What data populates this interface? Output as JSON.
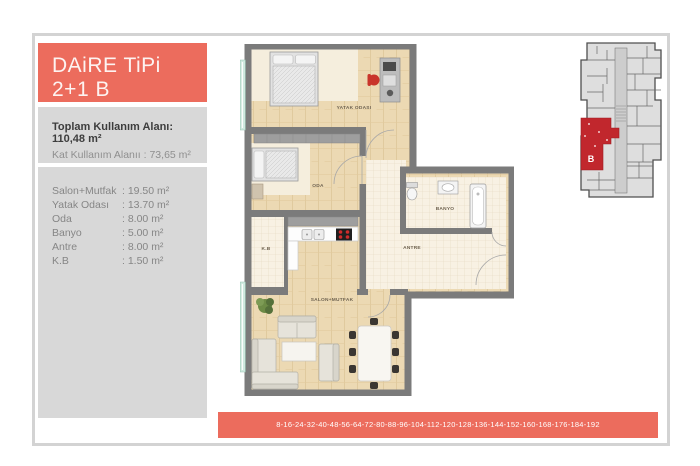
{
  "colors": {
    "coral": "#ec6c5d",
    "unit_red": "#c1272d",
    "wall_gray": "#7b7b7b"
  },
  "header": {
    "title_line1": "DAiRE TiPi",
    "title_line2": "2+1 B"
  },
  "stats": {
    "line1": "Toplam Kullanım Alanı: 110,48 m²",
    "line2": "Kat Kullanım Alanıı : 73,65 m²"
  },
  "areas": {
    "rows": [
      {
        "name": "Salon+Mutfak",
        "value": ": 19.50 m²"
      },
      {
        "name": "Yatak Odası",
        "value": ": 13.70 m²"
      },
      {
        "name": "Oda",
        "value": ": 8.00 m²"
      },
      {
        "name": "Banyo",
        "value": ": 5.00 m²"
      },
      {
        "name": "Antre",
        "value": ": 8.00 m²"
      },
      {
        "name": "K.B",
        "value": ": 1.50 m²"
      }
    ]
  },
  "plan": {
    "rooms": {
      "yatak_odasi": "YATAK ODASI",
      "oda": "ODA",
      "banyo": "BANYO",
      "antre": "ANTRE",
      "kb": "K.B",
      "salon_mutfak": "SALON+MUTFAK"
    }
  },
  "keyplan": {
    "unit": "B"
  },
  "footer": {
    "numbers": "8-16-24-32-40-48-56-64-72-80-88-96-104-112-120-128-136-144-152-160-168-176-184-192"
  }
}
